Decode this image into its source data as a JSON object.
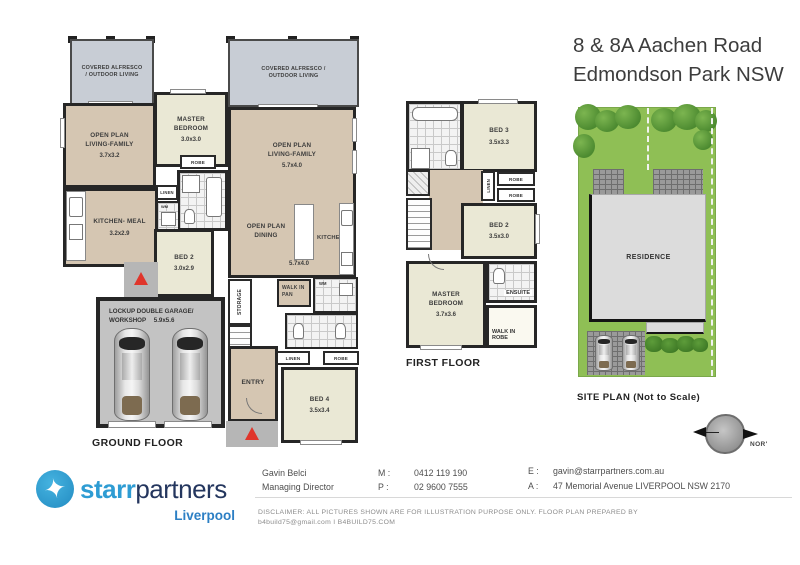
{
  "title": {
    "line1": "8 & 8A Aachen Road",
    "line2": "Edmondson Park NSW"
  },
  "ground_floor": {
    "caption": "GROUND FLOOR",
    "unit_left": {
      "alfresco": "COVERED ALFRESCO / OUTDOOR LIVING",
      "living": {
        "name": "OPEN PLAN LIVING-FAMILY",
        "dim": "3.7x3.2"
      },
      "master": {
        "name": "MASTER BEDROOM",
        "dim": "3.0x3.0"
      },
      "robe": "ROBE",
      "linen": "LINEN",
      "wm": "WM",
      "kitchen": {
        "name": "KITCHEN- MEAL",
        "dim": "3.2x2.9"
      },
      "bed2": {
        "name": "BED 2",
        "dim": "3.0x2.9"
      },
      "garage": {
        "name": "LOCKUP DOUBLE GARAGE/ WORKSHOP",
        "dim": "5.9x5.6"
      }
    },
    "unit_mid": {
      "alfresco": "COVERED ALFRESCO / OUTDOOR LIVING",
      "living": {
        "name": "OPEN PLAN LIVING-FAMILY",
        "dim": "5.7x4.0"
      },
      "dining": {
        "name": "OPEN PLAN DINING",
        "dim": "5.7x4.0"
      },
      "kitchen": "KITCHEN",
      "storage": "STORAGE",
      "walk_in_pan": "WALK IN PAN",
      "wm": "WM",
      "linen": "LINEN",
      "robe": "ROBE",
      "entry": "ENTRY",
      "bed4": {
        "name": "BED 4",
        "dim": "3.5x3.4"
      }
    }
  },
  "first_floor": {
    "caption": "FIRST FLOOR",
    "bed3": {
      "name": "BED 3",
      "dim": "3.5x3.3"
    },
    "robe_top": "ROBE",
    "robe_bottom": "ROBE",
    "linen": "LINEN",
    "bed2": {
      "name": "BED 2",
      "dim": "3.5x3.0"
    },
    "master": {
      "name": "MASTER BEDROOM",
      "dim": "3.7x3.6"
    },
    "ensuite": "ENSUITE",
    "walk_in_robe": "WALK IN ROBE"
  },
  "site_plan": {
    "caption": "SITE PLAN (Not to Scale)",
    "residence": "RESIDENCE"
  },
  "compass": {
    "label": "NOR'"
  },
  "footer": {
    "brand": {
      "starr": "starr",
      "partners": "partners",
      "location": "Liverpool"
    },
    "agent": {
      "name": "Gavin  Belci",
      "role": "Managing Director",
      "mobile_label": "M :",
      "mobile": "0412 119 190",
      "phone_label": "P :",
      "phone": "02 9600 7555",
      "email_label": "E :",
      "email": "gavin@starrpartners.com.au",
      "address_label": "A :",
      "address": "47 Memorial Avenue LIVERPOOL NSW 2170"
    },
    "disclaimer": {
      "line1": "DISCLAIMER: ALL PICTURES SHOWN ARE FOR ILLUSTRATION PURPOSE ONLY. FLOOR PLAN PREPARED BY",
      "line2": "b4build75@gmail.com   I   B4BUILD75.COM"
    }
  },
  "colors": {
    "accent_blue": "#2e9cd3",
    "navy": "#24365e",
    "liverpool_blue": "#2c7fc4",
    "arrow_red": "#e0352b",
    "lawn_green": "#8fbf55",
    "floor_tan": "#d5c6b2",
    "room_cream": "#eae8d5",
    "alfresco_grey": "#c8cdd5"
  }
}
